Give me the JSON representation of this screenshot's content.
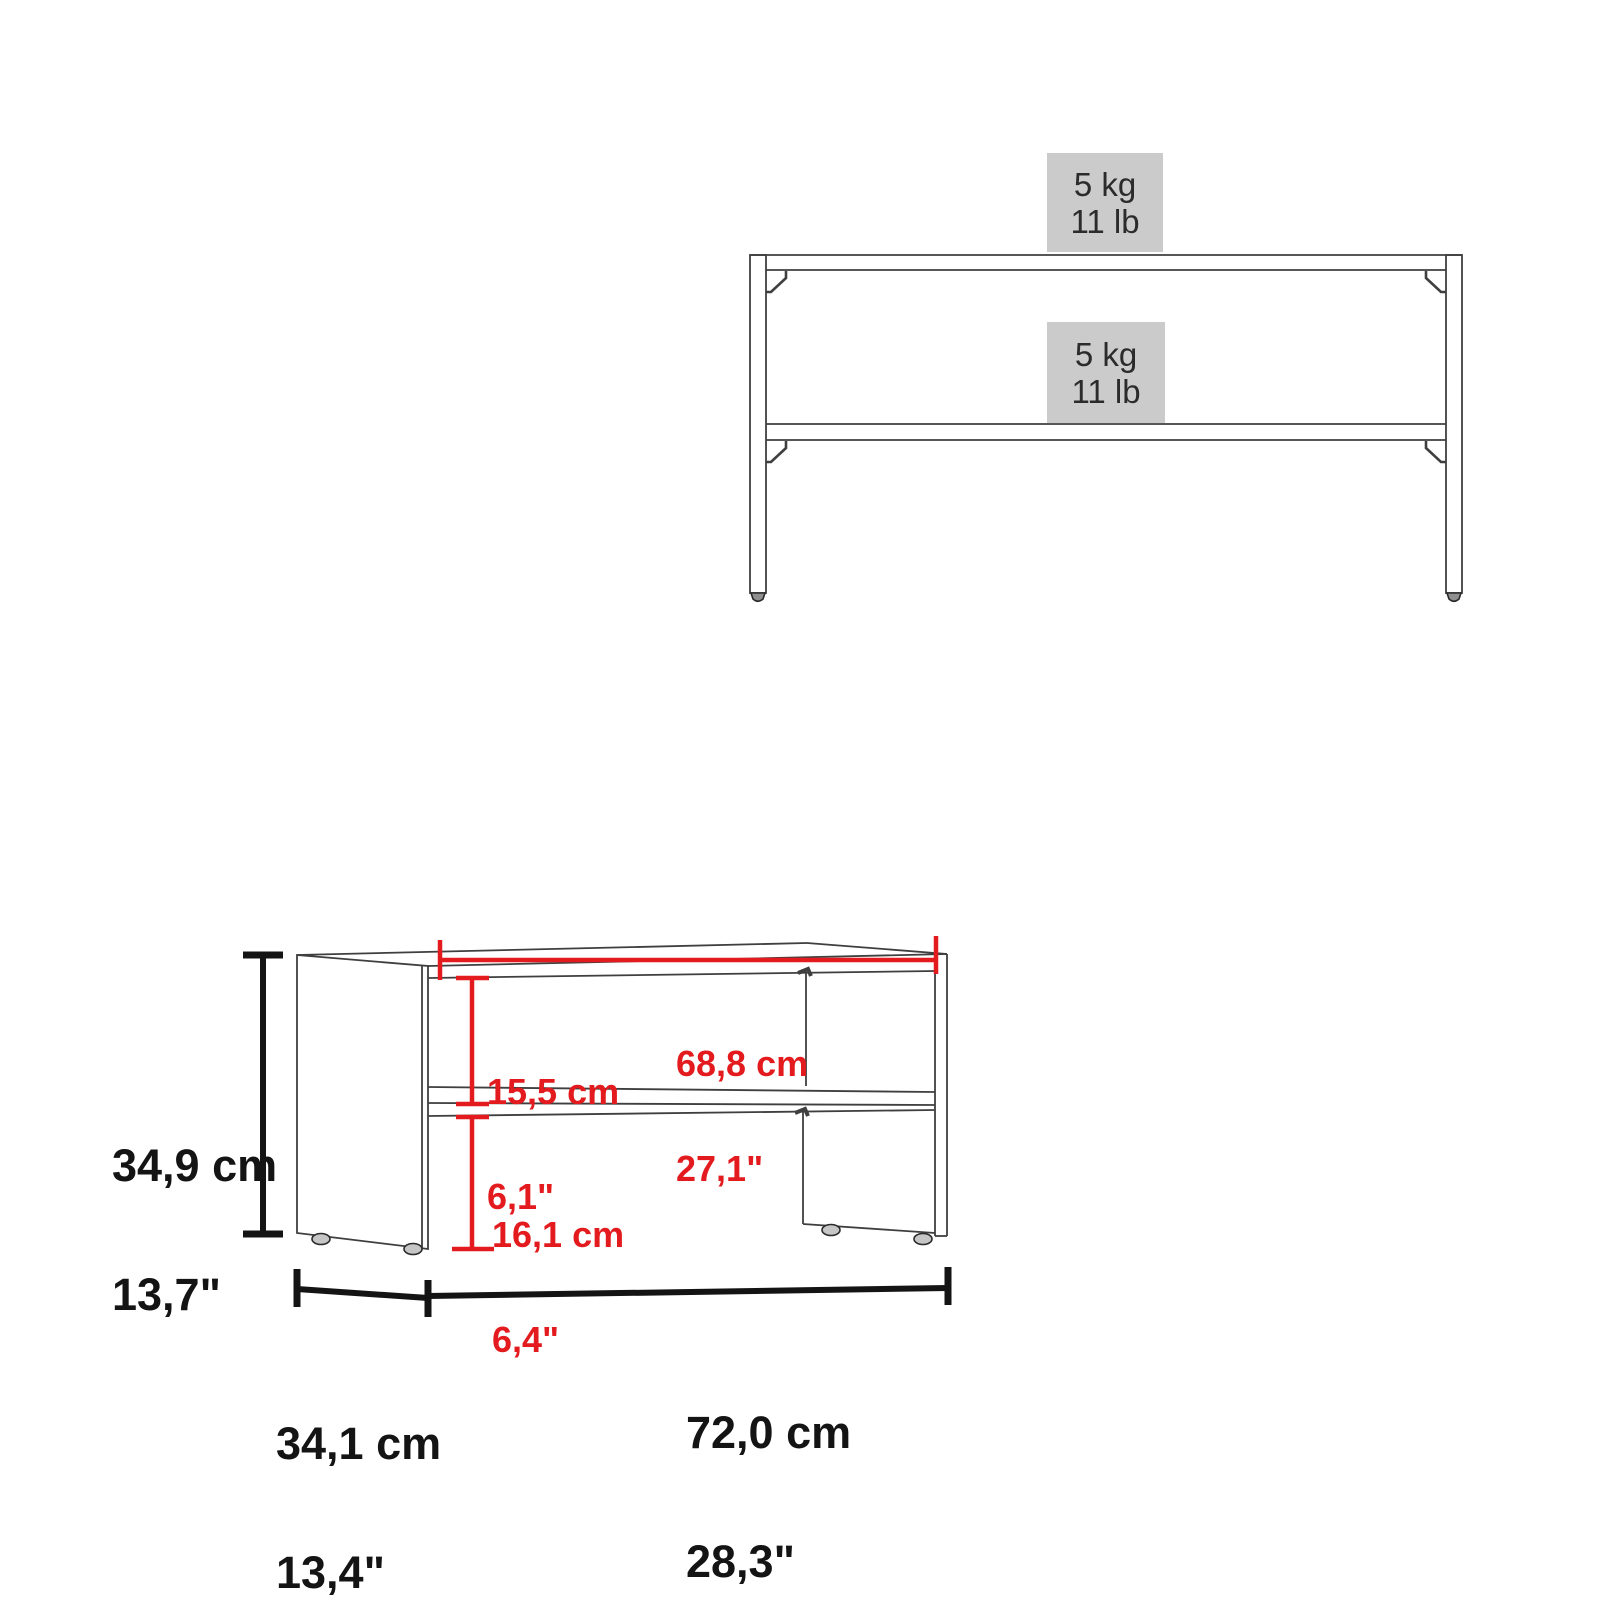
{
  "top_view": {
    "upper_capacity": {
      "kg": "5 kg",
      "lb": "11 lb"
    },
    "lower_capacity": {
      "kg": "5 kg",
      "lb": "11 lb"
    }
  },
  "dimensions": {
    "height_cm": "34,9 cm",
    "height_in": "13,7\"",
    "inner_width_cm": "68,8 cm",
    "inner_width_in": "27,1\"",
    "upper_space_cm": "15,5 cm",
    "upper_space_in": "6,1\"",
    "lower_space_cm": "16,1 cm",
    "lower_space_in": "6,4\"",
    "depth_cm": "34,1 cm",
    "depth_in": "13,4\"",
    "width_cm": "72,0 cm",
    "width_in": "28,3\""
  },
  "colors": {
    "dimension_red": "#e31b1e",
    "furniture_line": "#3f3f3f",
    "dimension_black": "#141414",
    "capacity_box_bg": "#cbcbcb"
  }
}
